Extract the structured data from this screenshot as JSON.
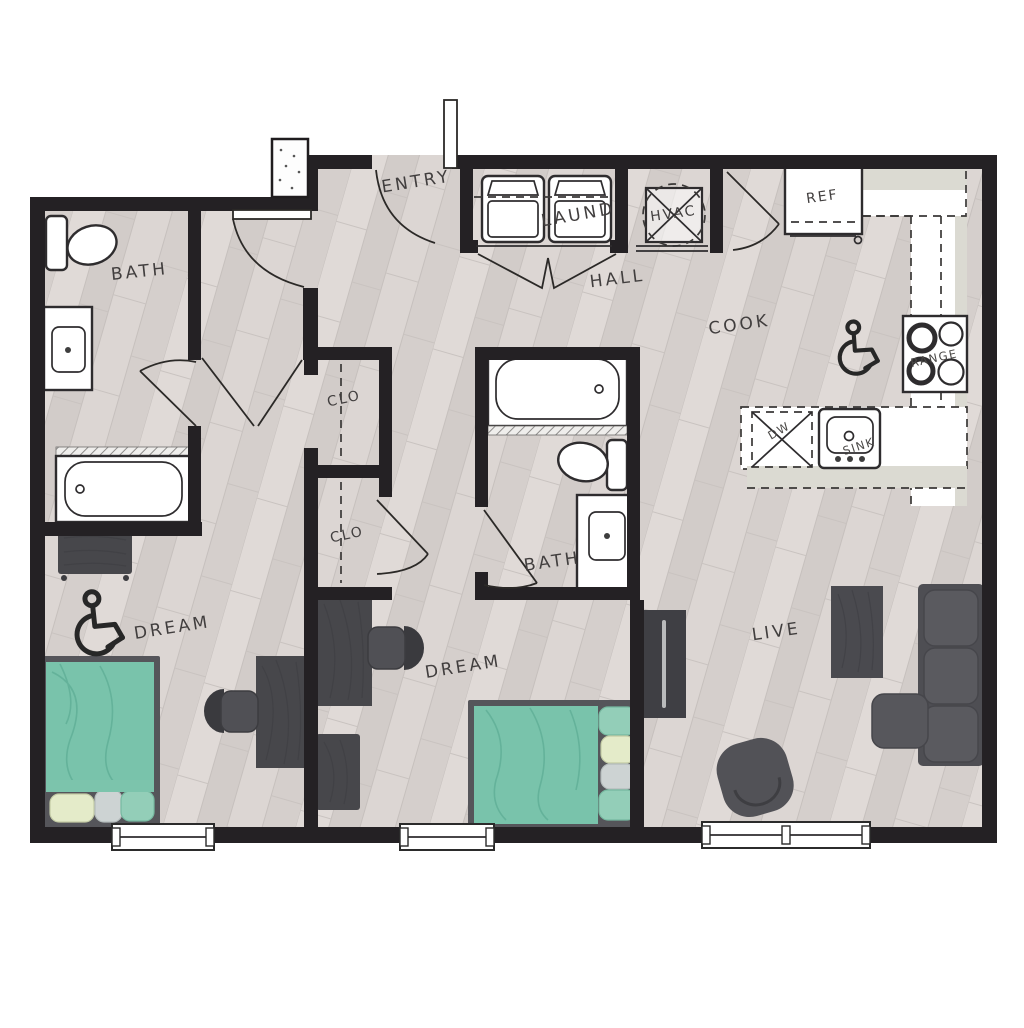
{
  "labels": {
    "bath1": "BATH",
    "entry": "ENTRY",
    "laundry": "LAUND",
    "hvac": "HVAC",
    "hall": "HALL",
    "cook": "COOK",
    "ref": "REF",
    "range": "RANGE",
    "dw": "DW",
    "sink": "SINK",
    "clo1": "CLO",
    "clo2": "CLO",
    "bath2": "BATH",
    "dream1": "DREAM",
    "dream2": "DREAM",
    "live": "LIVE"
  },
  "colors": {
    "wall": "#242124",
    "floor_wood": "#d9d3d0",
    "counter_gray": "#dbdad2",
    "bed_teal": "#79c3ab",
    "pillow_green": "#e4ebc9",
    "pillow_gray": "#cdd3d3",
    "pillow_teal": "#93ceb8",
    "furniture_dark": "#4c4c50",
    "fixture_outline": "#2e2c2e"
  },
  "icons": {
    "accessibility": "wheelchair"
  }
}
